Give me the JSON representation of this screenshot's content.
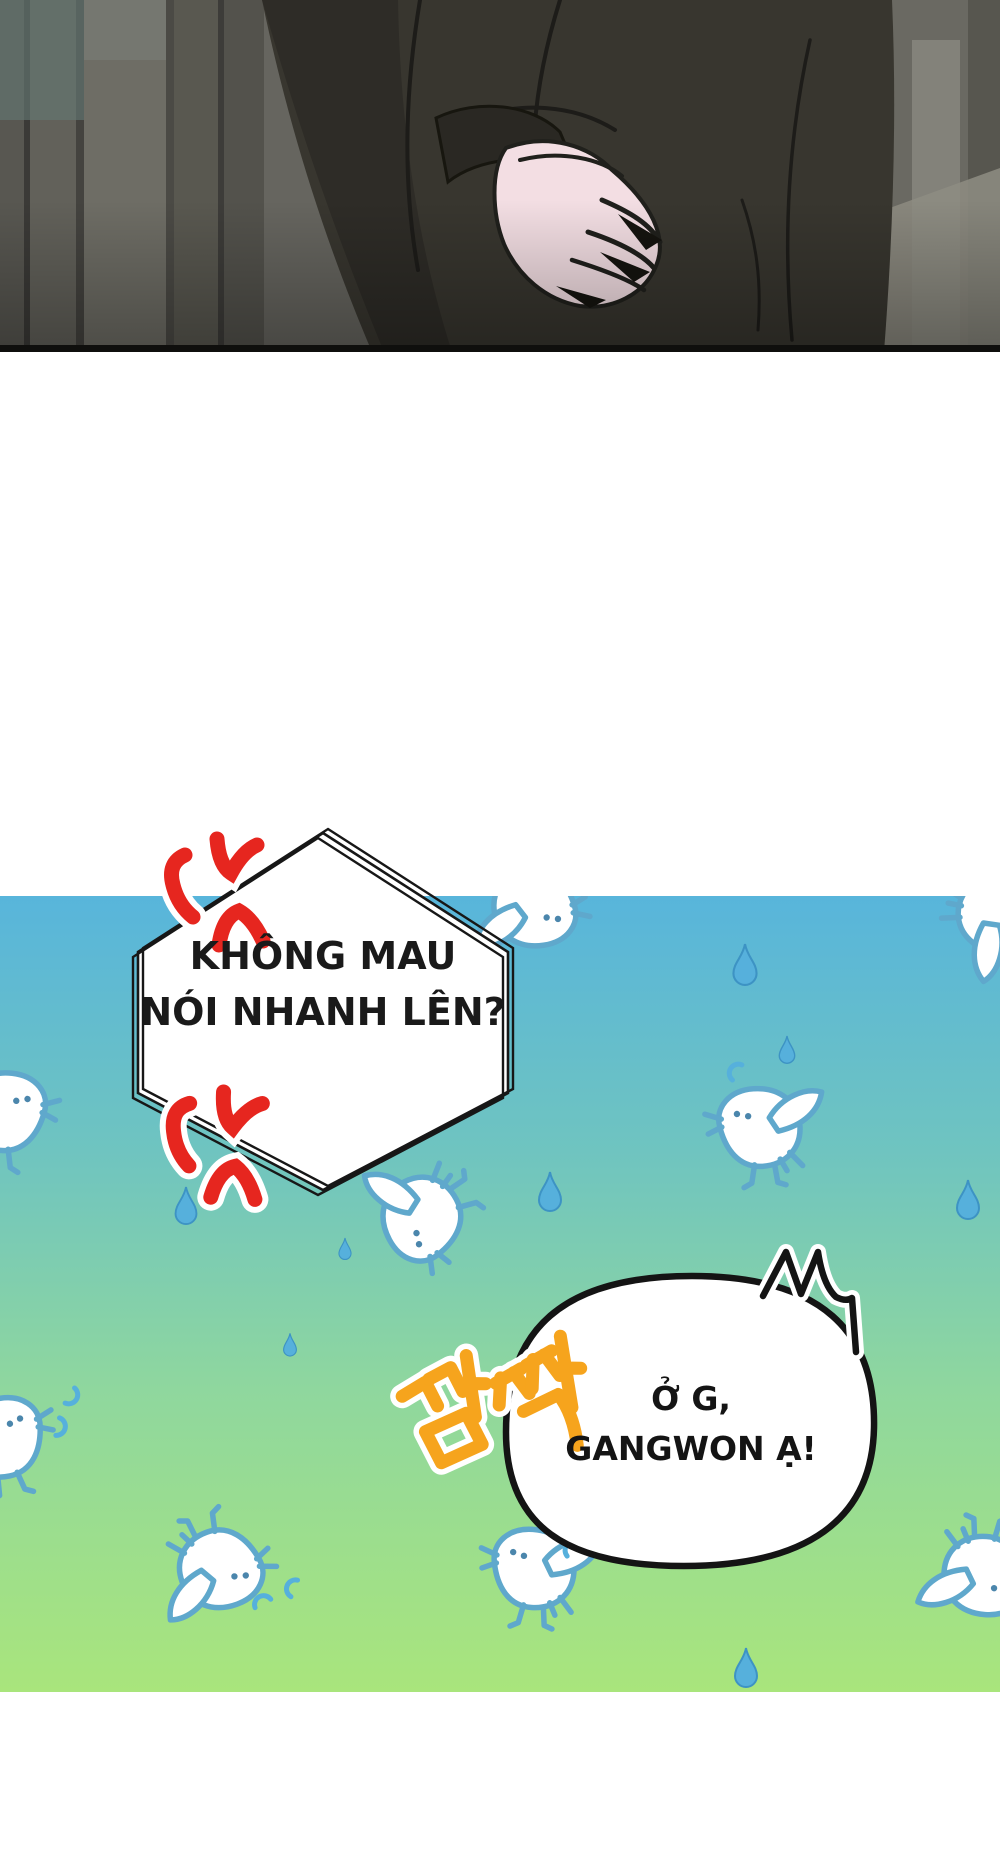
{
  "page": {
    "width": 1000,
    "height": 1867,
    "background": "#ffffff",
    "kind": "webtoon-comic-strip-page"
  },
  "speech_bubbles": {
    "hexagon": {
      "shape": "hexagon-sketchy",
      "fill": "#ffffff",
      "stroke": "#171717",
      "lines": [
        "KHÔNG MAU",
        "NÓI NHANH LÊN?"
      ],
      "text_color": "#1a1a1a"
    },
    "rounded": {
      "shape": "rounded-blob",
      "fill": "#ffffff",
      "stroke": "#141414",
      "lines": [
        "Ở G,",
        "GANGWON Ạ!"
      ],
      "text_color": "#141414"
    }
  },
  "sfx": {
    "korean_text": "깜짝",
    "color": "#F6A41D",
    "outline_color": "#ffffff",
    "rotation_deg": -14
  },
  "effects": {
    "anger_marks": {
      "count": 2,
      "color": "#E6261F",
      "outline_color": "#ffffff"
    },
    "surprise_scribble": {
      "color": "#141414",
      "outline_color": "#ffffff"
    }
  },
  "scene": {
    "top_panel": {
      "content": "dark suited torso with pale hand on hip against gray wall",
      "suit_color": "#38362f",
      "hand_color": "#F3DEE3",
      "wall_grays": [
        "#585751",
        "#62615a",
        "#6e6d65",
        "#595850",
        "#53524c"
      ]
    },
    "bottom_panel": {
      "gradient_top": "#58B5DB",
      "gradient_mid": "#7FCBAD",
      "gradient_bottom": "#A9E57C",
      "birds": {
        "count": 9,
        "body_color": "#ffffff",
        "outline_color": "#5FA8CC"
      },
      "raindrops": {
        "count": 8,
        "color": "#56B0DC"
      },
      "curl_droplets": {
        "count": 6,
        "color": "#56B0DC"
      }
    },
    "panel_border_color": "#0f0f0d"
  }
}
